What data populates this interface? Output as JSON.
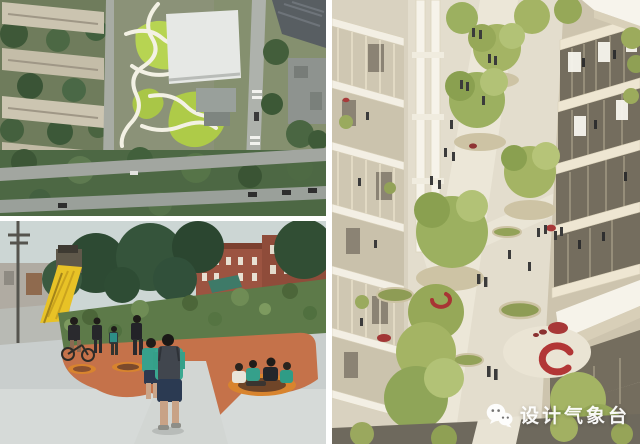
{
  "watermark": {
    "text": "设计气象台",
    "icon": "wechat-icon",
    "color": "#ffffff"
  },
  "collage": {
    "background": "#ffffff",
    "panels": [
      {
        "id": "aerial-site-photo"
      },
      {
        "id": "playground-plaza-photo"
      },
      {
        "id": "architectural-model-photo"
      }
    ]
  },
  "palette": {
    "lawn_green": "#b7d452",
    "tree_green": "#46603c",
    "slide_yellow": "#e8c226",
    "terracotta": "#c5724a",
    "circle_orange": "#d8842e",
    "shirt_teal": "#3aa890",
    "model_cream": "#efe9da",
    "model_tree_green": "#a4b464",
    "accent_red": "#b23636",
    "pavement_gray": "#c9cecd"
  }
}
